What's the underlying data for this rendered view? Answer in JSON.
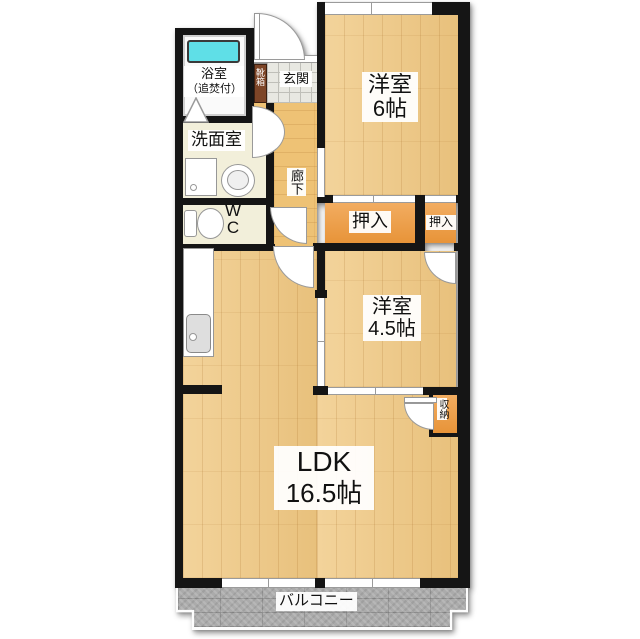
{
  "plan": {
    "rooms": {
      "bath": {
        "line1": "浴室",
        "line2": "（追焚付）"
      },
      "washroom": "洗面室",
      "wc": "WC",
      "genkan": "玄関",
      "shoe_box": "靴箱",
      "corridor": "廊下",
      "western_room_6": {
        "name": "洋室",
        "size": "6帖"
      },
      "closet_left": "押入",
      "closet_right": "押入",
      "western_room_45": {
        "name": "洋室",
        "size": "4.5帖"
      },
      "storage": "収納",
      "ldk": {
        "name": "LDK",
        "size": "16.5帖"
      },
      "balcony": "バルコニー"
    },
    "colors": {
      "wall": "#151515",
      "wood_floor": "#efc883",
      "closet_orange": "#ef9a3d",
      "shoe_box_brown": "#7d4527",
      "cream_floor": "#f2efda",
      "bathtub_cyan": "#5fdfe7",
      "balcony_gray": "#ababab",
      "tile_gray": "#e8e8e2"
    }
  }
}
